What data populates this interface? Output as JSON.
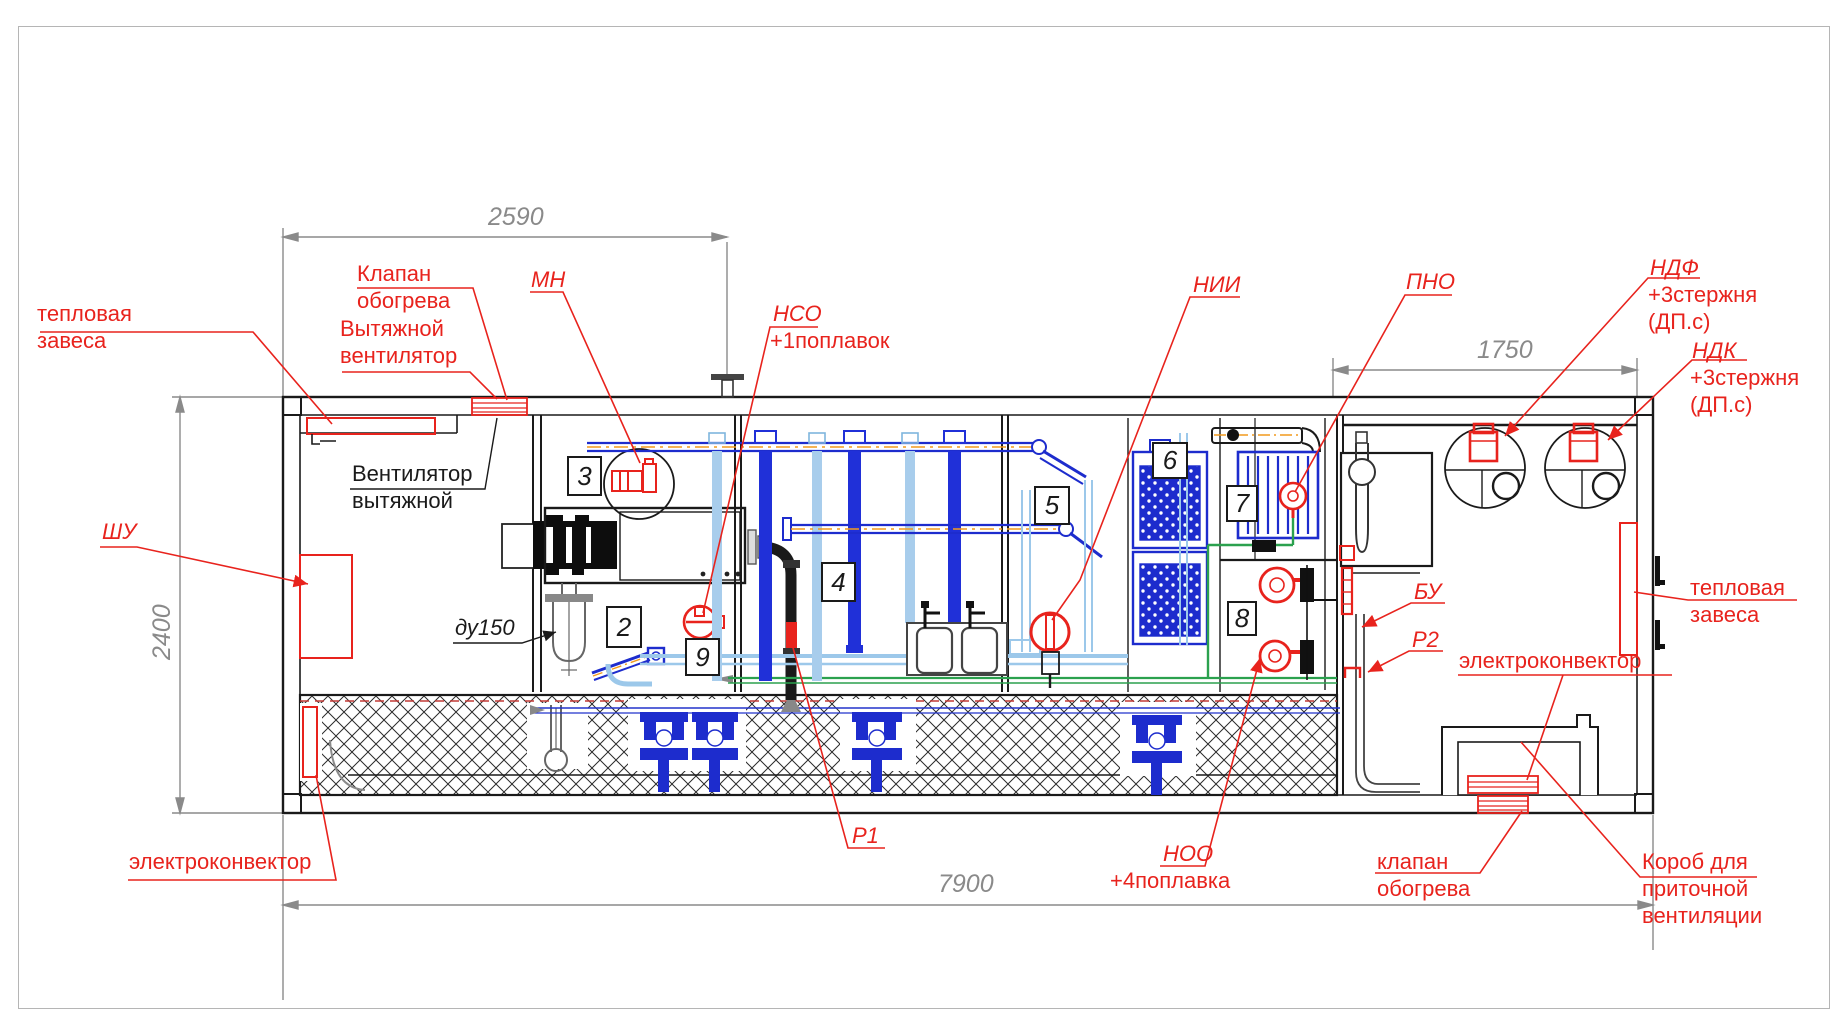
{
  "dimensions": {
    "top_span": "2590",
    "right_span": "1750",
    "height": "2400",
    "total_length": "7900"
  },
  "labels": {
    "thermal_curtain_left": [
      "тепловая",
      "завеса"
    ],
    "heating_valve_top": [
      "Клапан",
      "обогрева"
    ],
    "exhaust_fan_red": [
      "Вытяжной",
      "вентилятор"
    ],
    "mn": "МН",
    "nso": [
      "НСО",
      "+1поплавок"
    ],
    "nii": "НИИ",
    "pno": "ПНО",
    "ndf": [
      "НДФ",
      "+3стержня",
      "(ДП.с)"
    ],
    "ndk": [
      "НДК",
      "+3стержня",
      "(ДП.с)"
    ],
    "exhaust_fan_black": [
      "Вентилятор",
      "вытяжной"
    ],
    "shu": "ШУ",
    "du150": "ду150",
    "thermal_curtain_right": [
      "тепловая",
      "завеса"
    ],
    "bu": "БУ",
    "r2": "Р2",
    "electroconvector_right": "электроконвектор",
    "r1": "Р1",
    "noo": [
      "НОО",
      "+4поплавка"
    ],
    "heating_valve_bottom": [
      "клапан",
      "обогрева"
    ],
    "supply_duct": [
      "Короб для",
      "приточной",
      "вентиляции"
    ],
    "electroconvector_left": "электроконвектор"
  },
  "sections": {
    "n2": "2",
    "n3": "3",
    "n4": "4",
    "n5": "5",
    "n6": "6",
    "n7": "7",
    "n8": "8",
    "n9": "9"
  },
  "colors": {
    "red": "#e8231d",
    "blue": "#1f2bd4",
    "light_blue": "#9cc8ea",
    "green": "#2ba14e",
    "orange": "#f29a1d",
    "grey": "#8a8a8a",
    "black": "#1a1a1a"
  }
}
